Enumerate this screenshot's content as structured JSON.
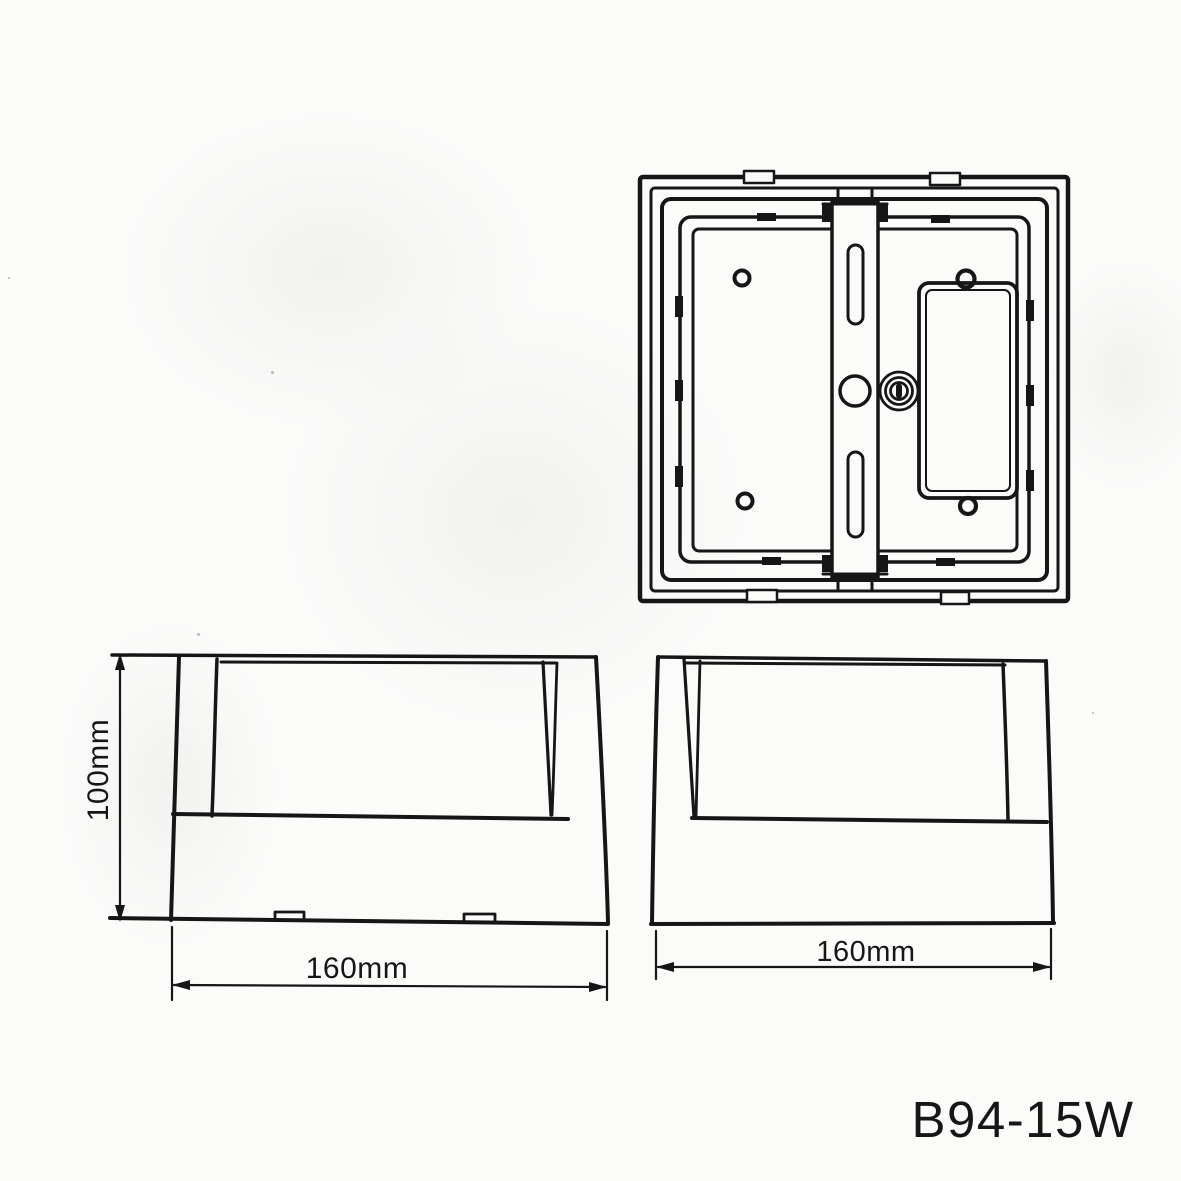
{
  "page": {
    "background_color": "#fbfbfa",
    "ink_color": "#161616"
  },
  "drawing": {
    "product_code": "B94-15W",
    "dimensions": {
      "side_left_height": "100mm",
      "side_left_width": "160mm",
      "side_right_width": "160mm"
    }
  }
}
